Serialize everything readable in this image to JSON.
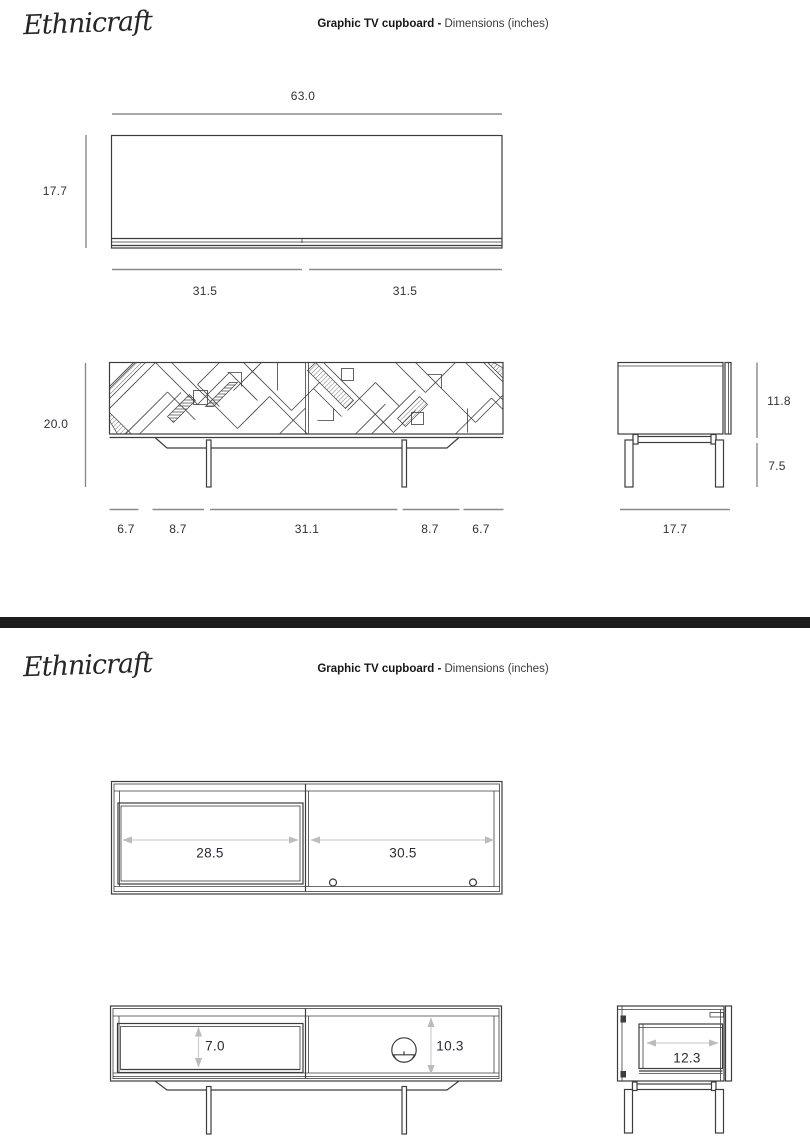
{
  "colors": {
    "line": "#3d3d3d",
    "dimension_line": "#8a8a8a",
    "arrow": "#cfcfcf",
    "label_text": "#2f3138",
    "divider_bar": "#1d1d1d",
    "background": "#ffffff",
    "door_panel_fill": "#c6c6c6"
  },
  "page1": {
    "logo": "Ethnicraft",
    "title": {
      "product": "Graphic TV cupboard -",
      "subtitle": "Dimensions (inches)"
    },
    "top_view": {
      "overall_width": "63.0",
      "depth": "17.7",
      "door_left_width": "31.5",
      "door_right_width": "31.5"
    },
    "front_view": {
      "overall_height": "20.0",
      "left_overhang": "6.7",
      "left_leg_inset": "8.7",
      "leg_span": "31.1",
      "right_leg_inset": "8.7",
      "right_overhang": "6.7"
    },
    "side_view": {
      "body_height": "11.8",
      "leg_height": "7.5",
      "depth": "17.7"
    }
  },
  "page2": {
    "logo": "Ethnicraft",
    "title": {
      "product": "Graphic TV cupboard -",
      "subtitle": "Dimensions (inches)"
    },
    "open_view": {
      "left_opening_width": "28.5",
      "right_opening_width": "30.5"
    },
    "open_front_view": {
      "drawer_opening_height": "7.0",
      "niche_height": "10.3"
    },
    "open_side_view": {
      "inner_depth": "12.3"
    }
  }
}
